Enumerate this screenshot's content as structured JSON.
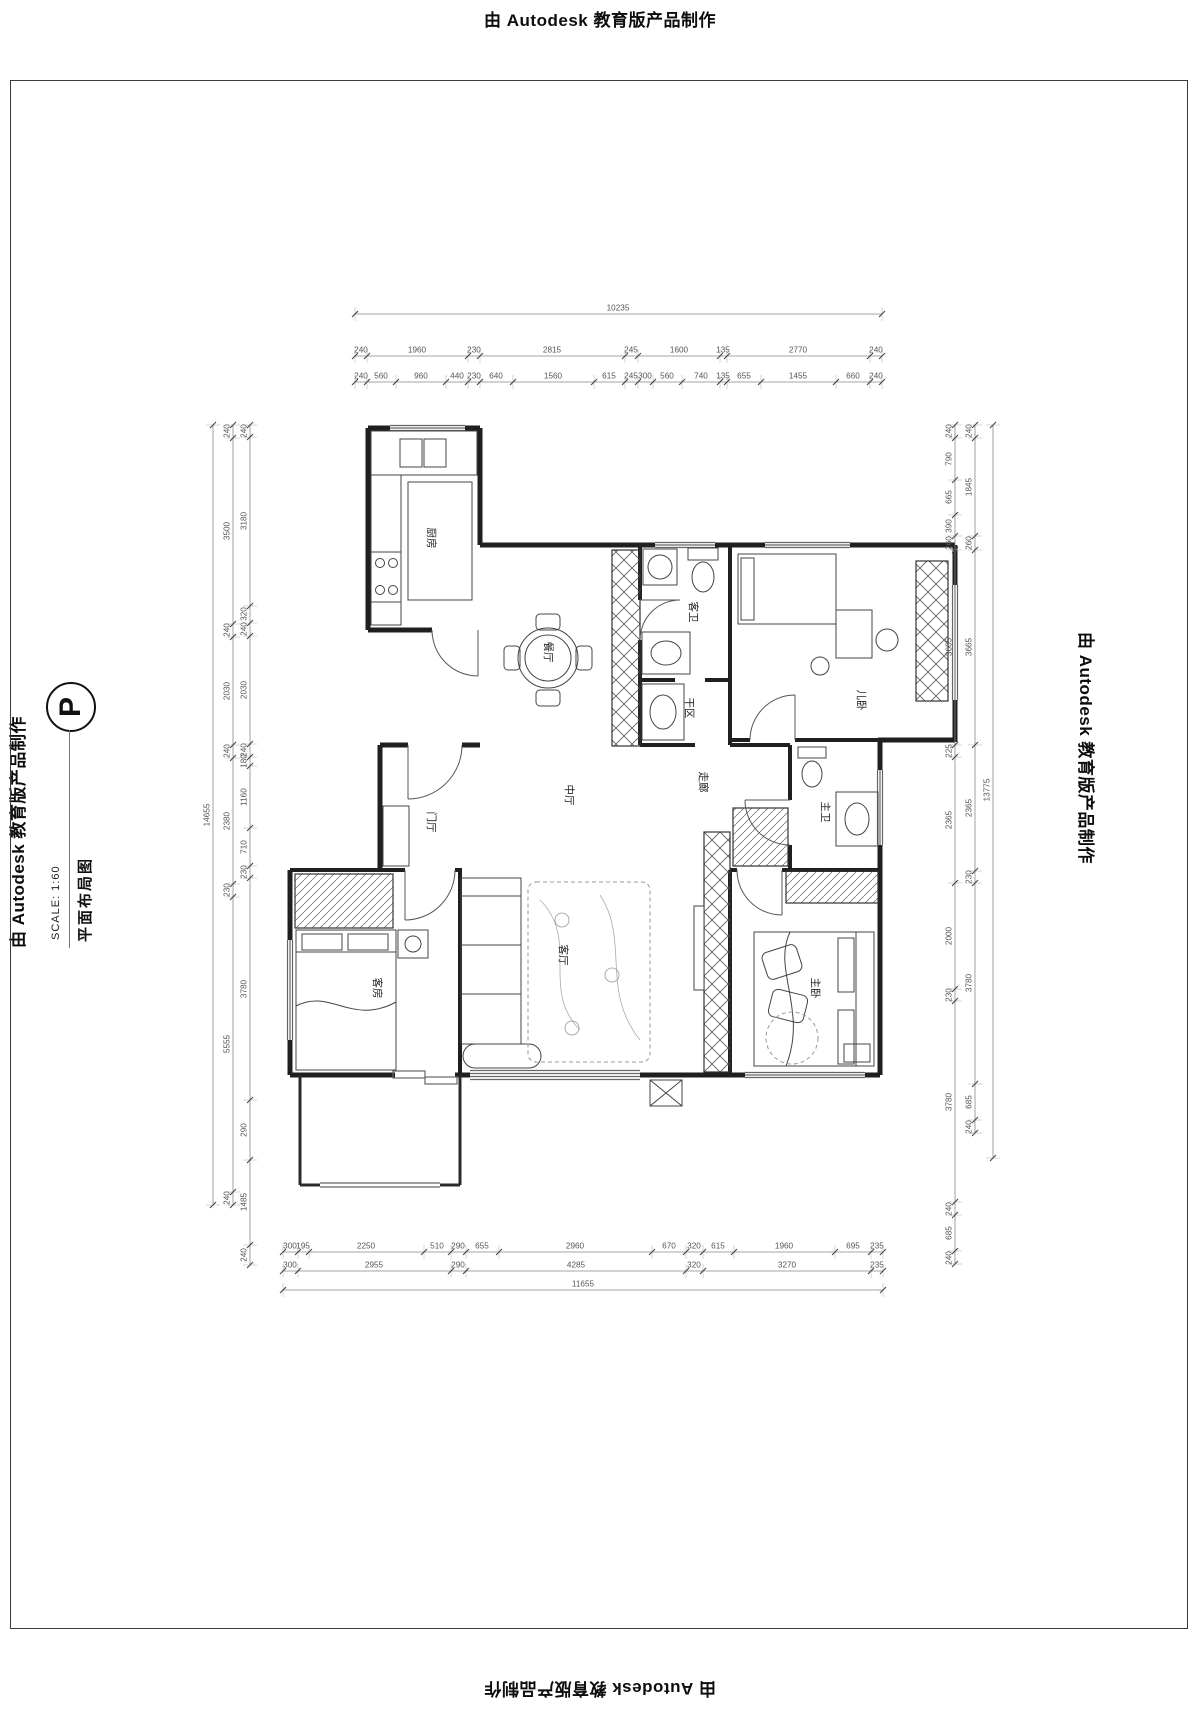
{
  "page": {
    "top_banner": "由 Autodesk 教育版产品制作",
    "bottom_banner": "由 Autodesk 教育版产品制作",
    "left_banner": "由 Autodesk 教育版产品制作",
    "right_banner": "由 Autodesk 教育版产品制作"
  },
  "title_block": {
    "symbol": "P",
    "title": "平面布局图",
    "scale": "SCALE: 1:60"
  },
  "rooms": [
    {
      "id": "kitchen",
      "label": "厨房"
    },
    {
      "id": "dining",
      "label": "餐厅"
    },
    {
      "id": "guest-bath",
      "label": "客卫"
    },
    {
      "id": "dry-area",
      "label": "干区"
    },
    {
      "id": "kids-bedroom",
      "label": "儿卧"
    },
    {
      "id": "corridor",
      "label": "走廊"
    },
    {
      "id": "master-bath",
      "label": "主卫"
    },
    {
      "id": "middle-hall",
      "label": "中厅"
    },
    {
      "id": "foyer",
      "label": "门厅"
    },
    {
      "id": "living-room",
      "label": "客厅"
    },
    {
      "id": "guest-bedroom",
      "label": "客房"
    },
    {
      "id": "master-bedroom",
      "label": "主卧"
    }
  ],
  "dimensions": {
    "top": {
      "total": "10235",
      "row1": [
        "240",
        "1960",
        "230",
        "2815",
        "245",
        "1600",
        "135",
        "2770",
        "240"
      ],
      "row2": [
        "240",
        "560",
        "960",
        "440",
        "230",
        "640",
        "1560",
        "615",
        "245",
        "300",
        "560",
        "740",
        "135",
        "655",
        "1455",
        "660",
        "240"
      ]
    },
    "bottom": {
      "row1": [
        "300",
        "195",
        "2250",
        "510",
        "290",
        "655",
        "2960",
        "670",
        "320",
        "615",
        "1960",
        "695",
        "235"
      ],
      "row2": [
        "300",
        "2955",
        "290",
        "4285",
        "320",
        "3270",
        "235"
      ],
      "total": "11655"
    },
    "left": {
      "total": "14655",
      "outer": [
        "240",
        "3500",
        "240",
        "2030",
        "240",
        "2380",
        "230",
        "5555",
        "240"
      ],
      "inner": [
        "240",
        "3180",
        "320",
        "240",
        "2030",
        "240",
        "180",
        "1160",
        "710",
        "230",
        "3780",
        "290",
        "1485",
        "240"
      ]
    },
    "right": {
      "total": "13775",
      "outer": [
        "240",
        "1845",
        "260",
        "3665",
        "2365",
        "230",
        "3780",
        "685",
        "240"
      ],
      "inner": [
        "240",
        "790",
        "665",
        "390",
        "260",
        "3665",
        "225",
        "2365",
        "2000",
        "230",
        "3780",
        "240",
        "685",
        "240"
      ]
    }
  },
  "colors": {
    "wall_line": "#1f1f1f",
    "dim_text": "#555555",
    "room_text": "#222222"
  }
}
